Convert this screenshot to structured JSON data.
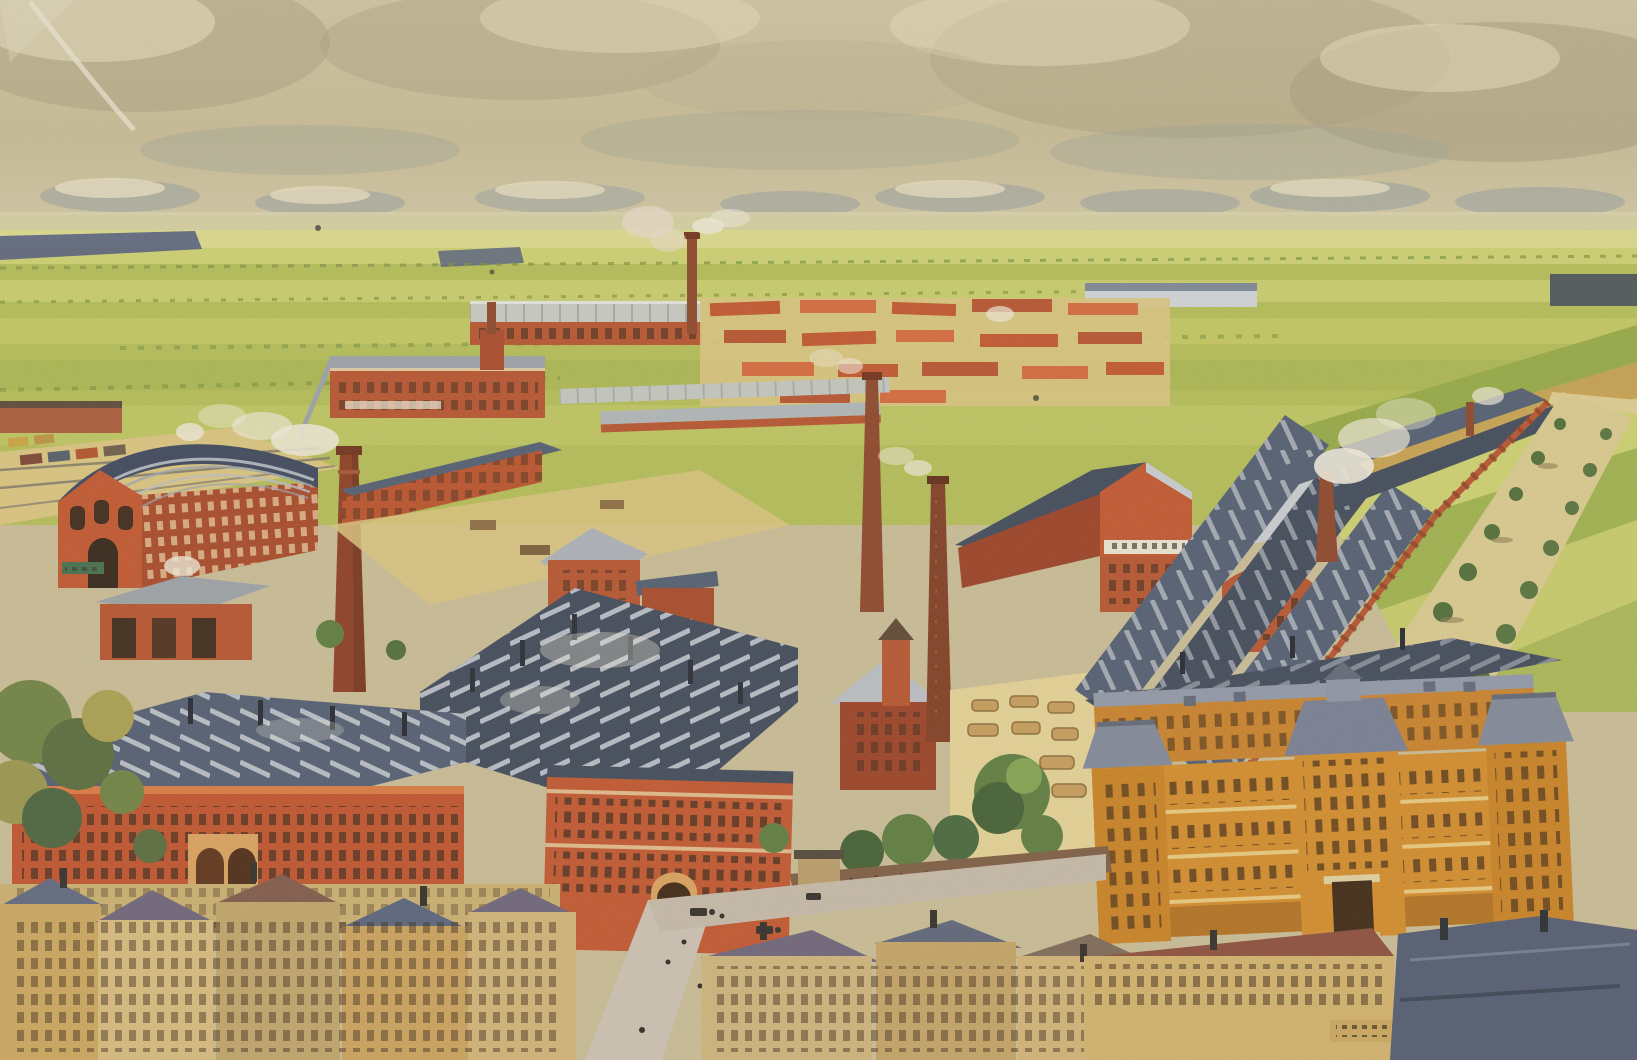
{
  "meta": {
    "type": "vintage postcard illustration",
    "subject": "Bird's-eye view of a sprawling red-brick factory complex surrounded by flat farmland, with a town in the foreground",
    "style": "early 20th century chromolithograph, halftone grain, sepia-toned sky",
    "width_px": 1637,
    "height_px": 1060
  },
  "palette": {
    "sky_base": "#c8bb95",
    "sky_light": "#ded3b2",
    "cloud_dark": "#a29878",
    "cloud_gray": "#9aa192",
    "cloud_cream": "#e9dfc0",
    "cloud_blue": "#8e99a0",
    "haze": "#d8d2ae",
    "field_light": "#ccd06f",
    "field_mid": "#b2bc55",
    "field_dark": "#93a843",
    "field_pale": "#dbd98c",
    "field_orange": "#c89b4e",
    "treeline_blue": "#46517c",
    "hedge_green": "#77923f",
    "brick": "#c0532c",
    "brick_dark": "#993d22",
    "brick_deep": "#8a3a20",
    "brick_light": "#d4663a",
    "roof_slate": "#4e5a70",
    "roof_slate_dark": "#3c4658",
    "roof_light": "#b9bdc6",
    "roof_pale": "#c8ccd1",
    "roof_purple": "#6a6178",
    "roof_brown": "#7e5648",
    "yard_tan": "#d9c37e",
    "yard_light": "#e3d194",
    "road_mauve": "#cbc0b2",
    "admin_orange": "#d28a28",
    "admin_orange_dark": "#b06f1e",
    "admin_roof": "#7e8698",
    "smoke_white": "#efeadb",
    "tree_green": "#5a7a3c",
    "tree_dark": "#3f5c30",
    "tree_autumn": "#a3a24a",
    "town_wall": "#d6ba7c",
    "town_wall2": "#c9a05a",
    "sign_cream": "#e9e3d3",
    "ink_dark": "#2e2418"
  },
  "scene": {
    "sky": "hazy tan sky filled with gray-olive cumulus clouds lit cream, low bank of blue-gray clouds along the horizon",
    "background": "flat patchwork farmland in strips of green, yellow and ochre receding to a high horizon; dark blue-green tree rows at left; a distant pale row of buildings at right; a tan tree-lined avenue bordering the factory on the right",
    "factory": {
      "description": "dense complex of red brick workshops with blue-gray sawtooth roofs, paved tan yards, and many smoking chimneys",
      "landmarks": [
        "arched-roof engine hall with ribbed roof at left",
        "very tall brick chimney left of center with drifting white smoke",
        "two tall brick chimneys at center",
        "large gabled hall with an illegible painted sign band",
        "barrel-vaulted hall with louvered roof vents at right",
        "long parallel sheds with skylight strips receding to the upper right behind a crenellated red wall",
        "ornate orange administration building with slate mansard roofs and corner pavilions at lower right",
        "long red factory facade with double arched gateway at lower left"
      ],
      "tall_chimneys_visible": 6,
      "small_roof_chimneys": "many",
      "rail_siding": "small railway siding with goods wagons at the far left"
    },
    "foreground": {
      "town": "rows of small town houses with tan facades and slate, purple and red-brown roofs along the bottom edge",
      "street": "light diagonal street with horse-drawn carriages and tiny pedestrians",
      "details": [
        "walled factory garden with green trees",
        "lumber stacks in an open yard",
        "autumn-colored trees at the lower left",
        "illegible painted shop-sign band on the lower-right houses",
        "postcard wear: pale crease at the top-left corner and small dark printing specks"
      ]
    }
  }
}
